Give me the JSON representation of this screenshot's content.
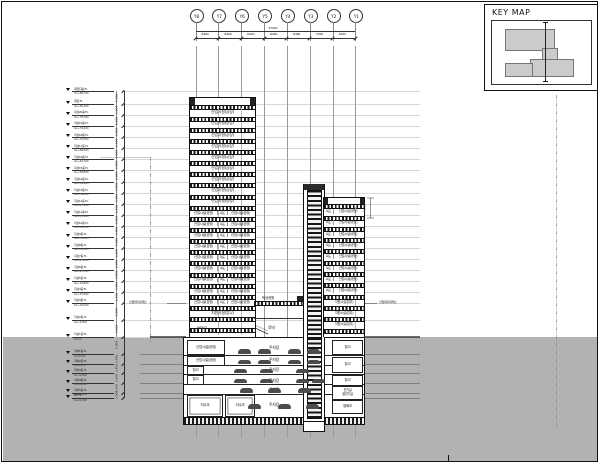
{
  "key_map": {
    "title": "KEY MAP"
  },
  "grid": {
    "bubbles": [
      "Y8",
      "Y7",
      "Y6",
      "Y5",
      "Y4",
      "Y3",
      "Y2",
      "Y1"
    ],
    "total": "57,600",
    "segments": [
      "8,400",
      "8,400",
      "8,400",
      "8,400",
      "8,400",
      "7,500",
      "8,100"
    ]
  },
  "levels": [
    {
      "name": "옥탑지붕 FL",
      "gl": "GL+86,700",
      "mm": 86700
    },
    {
      "name": "옥탑 FL",
      "gl": "GL+82,200",
      "mm": 82200
    },
    {
      "name": "지상20층 FL",
      "gl": "GL+78,300",
      "mm": 78300
    },
    {
      "name": "지상19층 FL",
      "gl": "GL+74,400",
      "mm": 74400
    },
    {
      "name": "지상18층 FL",
      "gl": "GL+70,500",
      "mm": 70500
    },
    {
      "name": "지상17층 FL",
      "gl": "GL+66,600",
      "mm": 66600
    },
    {
      "name": "지상16층 FL",
      "gl": "GL+62,700",
      "mm": 62700
    },
    {
      "name": "지상15층 FL",
      "gl": "GL+58,800",
      "mm": 58800
    },
    {
      "name": "지상14층 FL",
      "gl": "GL+54,900",
      "mm": 54900
    },
    {
      "name": "지상13층 FL",
      "gl": "GL+51,000",
      "mm": 51000
    },
    {
      "name": "지상12층 FL",
      "gl": "GL+47,100",
      "mm": 47100
    },
    {
      "name": "지상11층 FL",
      "gl": "GL+43,200",
      "mm": 43200
    },
    {
      "name": "지상10층 FL",
      "gl": "GL+39,300",
      "mm": 39300
    },
    {
      "name": "지상9층 FL",
      "gl": "GL+35,400",
      "mm": 35400
    },
    {
      "name": "지상8층 FL",
      "gl": "GL+31,500",
      "mm": 31500
    },
    {
      "name": "지상7층 FL",
      "gl": "GL+27,600",
      "mm": 27600
    },
    {
      "name": "지상6층 FL",
      "gl": "GL+23,700",
      "mm": 23700
    },
    {
      "name": "지상5층 FL",
      "gl": "GL+19,800",
      "mm": 19800
    },
    {
      "name": "지상4층 FL",
      "gl": "GL+15,900",
      "mm": 15900
    },
    {
      "name": "지상3층 FL",
      "gl": "GL+12,000",
      "mm": 12000
    },
    {
      "name": "지상2층 FL",
      "gl": "GL+6,000",
      "mm": 6000
    },
    {
      "name": "지상1층 FL",
      "gl": "GL±0",
      "mm": 0
    },
    {
      "name": "지하1층 FL",
      "gl": "GL-6,000",
      "mm": -6000
    },
    {
      "name": "지하2층 FL",
      "gl": "GL-9,400",
      "mm": -9400
    },
    {
      "name": "지하3층 FL",
      "gl": "GL-12,800",
      "mm": -12800
    },
    {
      "name": "지하4층 FL",
      "gl": "GL-16,200",
      "mm": -16200
    },
    {
      "name": "지하5층 FL",
      "gl": "GL-19,600",
      "mm": -19600
    },
    {
      "name": "PIT FL",
      "gl": "GL-21,600",
      "mm": -21600
    }
  ],
  "rooms": {
    "industrial": "산업시설(공장)",
    "corridor": "복도",
    "support": "지원시설(업무)",
    "mdf": "MDF실",
    "lobby": "로비",
    "roof_garden": "옥상정원",
    "parking": "주차장",
    "storage": "창고",
    "electrical": "전기실",
    "generator": "발전기실",
    "septic": "정화조",
    "water_tank": "저수조"
  },
  "left_tower_floors": [
    "s",
    "s",
    "s",
    "s",
    "s",
    "s",
    "s",
    "s",
    "s",
    "d",
    "d",
    "d",
    "d",
    "d",
    "d",
    "d",
    "d",
    "d",
    "sup",
    "mdf"
  ],
  "right_tower_floors": [
    "c",
    "c",
    "c",
    "c",
    "c",
    "c",
    "c",
    "c",
    "sup",
    "sup",
    "sup"
  ],
  "parking_levels": [
    "주차장",
    "주차장",
    "주차장",
    "주차장",
    "주차장",
    "주차장"
  ],
  "callouts": {
    "left_boundary": "인접대지경계선",
    "right_boundary": "인접대지경계선",
    "core_height_dim": "4,500"
  }
}
